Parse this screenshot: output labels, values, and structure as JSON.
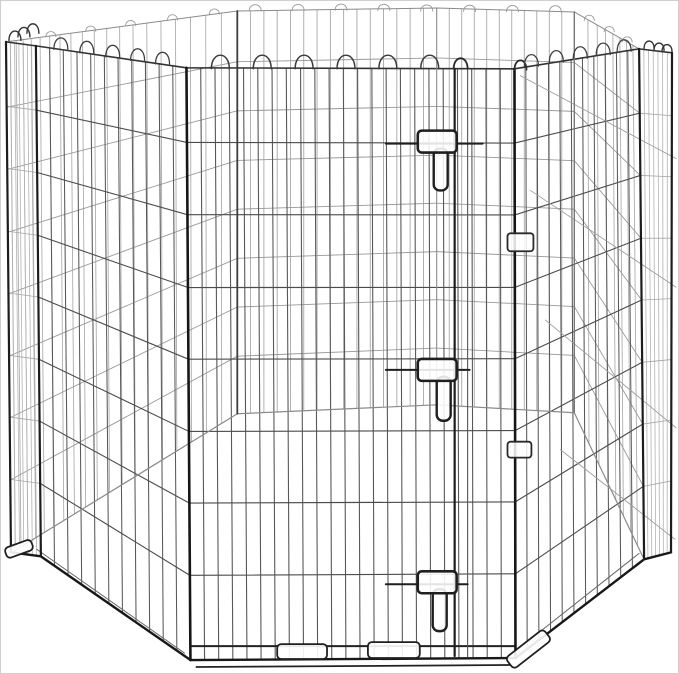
{
  "meta": {
    "alt_text": "Foldable black metal wire octagonal pet exercise pen with door and latches, on white background",
    "canvas": {
      "w": 679,
      "h": 674
    },
    "background": "#ffffff",
    "frame_border": "#cfcfcf"
  },
  "product": {
    "kind": "wire-exercise-pen",
    "visible_panels": "octagonal arrangement",
    "door_latches": 3,
    "hinge_clips": 2,
    "foot_tabs": 4,
    "wire_colors": {
      "dark": "#161616",
      "mid": "#4c4c4c",
      "light": "#9a9a9a",
      "faint": "#b2b2b2"
    }
  },
  "figure": {
    "rows": [
      0.126,
      0.248,
      0.371,
      0.492,
      0.614,
      0.735,
      0.857
    ],
    "panels": [
      {
        "name": "panel-far-left",
        "ta": [
          6,
          42
        ],
        "tb": [
          237,
          10
        ],
        "ba": [
          11,
          553
        ],
        "bb": [
          237,
          414
        ],
        "nv": 19,
        "bias": 1.4,
        "vc": "#a8a8a8",
        "vw": 0.85,
        "hc": "#9a9a9a",
        "hw": 0.9
      },
      {
        "name": "panel-back-left",
        "ta": [
          237,
          10
        ],
        "tb": [
          437,
          7
        ],
        "ba": [
          237,
          414
        ],
        "bb": [
          437,
          405
        ],
        "nv": 14,
        "bias": 1,
        "vc": "#a2a2a2",
        "vw": 0.85,
        "hc": "#989898",
        "hw": 0.9
      },
      {
        "name": "panel-back-right",
        "ta": [
          437,
          7
        ],
        "tb": [
          575,
          11
        ],
        "ba": [
          437,
          405
        ],
        "bb": [
          575,
          413
        ],
        "nv": 10,
        "bias": 1,
        "vc": "#a2a2a2",
        "vw": 0.85,
        "hc": "#989898",
        "hw": 0.9
      },
      {
        "name": "panel-far-right",
        "ta": [
          575,
          11
        ],
        "tb": [
          640,
          48
        ],
        "ba": [
          575,
          413
        ],
        "bb": [
          645,
          560
        ],
        "nv": 7,
        "bias": 0.75,
        "vc": "#a8a8a8",
        "vw": 0.85,
        "hc": "#9a9a9a",
        "hw": 0.9
      },
      {
        "name": "panel-edge-left",
        "ta": [
          5,
          41
        ],
        "tb": [
          35,
          45
        ],
        "ba": [
          10,
          553
        ],
        "bb": [
          40,
          557
        ],
        "nv": 6,
        "bias": 1,
        "vc": "#b2b2b2",
        "vw": 0.8,
        "hc": "#a5a5a5",
        "hw": 0.8
      },
      {
        "name": "panel-edge-right",
        "ta": [
          640,
          48
        ],
        "tb": [
          673,
          52
        ],
        "ba": [
          645,
          560
        ],
        "bb": [
          672,
          553
        ],
        "nv": 6,
        "bias": 1,
        "vc": "#b2b2b2",
        "vw": 0.8,
        "hc": "#a5a5a5",
        "hw": 0.8
      },
      {
        "name": "panel-near-left",
        "ta": [
          35,
          45
        ],
        "tb": [
          186,
          67
        ],
        "ba": [
          40,
          557
        ],
        "bb": [
          190,
          661
        ],
        "nv": 10,
        "bias": 1,
        "vc": "#585858",
        "vw": 1.05,
        "hc": "#4c4c4c",
        "hw": 1.1
      },
      {
        "name": "panel-front-door",
        "ta": [
          186,
          67
        ],
        "tb": [
          515,
          68
        ],
        "ba": [
          190,
          661
        ],
        "bb": [
          516,
          659
        ],
        "nv": 22,
        "bias": 1,
        "vc": "#585858",
        "vw": 1.1,
        "hc": "#4c4c4c",
        "hw": 1.15
      },
      {
        "name": "panel-near-right",
        "ta": [
          515,
          68
        ],
        "tb": [
          640,
          48
        ],
        "ba": [
          516,
          659
        ],
        "bb": [
          645,
          560
        ],
        "nv": 10,
        "bias": 1,
        "vc": "#585858",
        "vw": 1.05,
        "hc": "#4c4c4c",
        "hw": 1.1
      }
    ],
    "far_first": 6,
    "posts": [
      {
        "name": "post-back-left",
        "p": [
          237,
          10,
          237,
          414
        ],
        "w": 1.8,
        "c": "#3c3c3c",
        "far": true
      },
      {
        "name": "post-back-center",
        "p": [
          437,
          7,
          437,
          405
        ],
        "w": 1.1,
        "c": "#8a8a8a",
        "far": true
      },
      {
        "name": "post-back-right",
        "p": [
          575,
          11,
          575,
          413
        ],
        "w": 1.4,
        "c": "#777777",
        "far": true
      },
      {
        "name": "post-corner-left-outer",
        "p": [
          5,
          41,
          10,
          553
        ],
        "w": 2.2,
        "c": "#1c1c1c"
      },
      {
        "name": "post-corner-left-inner",
        "p": [
          35,
          45,
          40,
          557
        ],
        "w": 2.2,
        "c": "#1c1c1c"
      },
      {
        "name": "post-door-left",
        "p": [
          186,
          67,
          190,
          661
        ],
        "w": 2.6,
        "c": "#161616"
      },
      {
        "name": "door-stile-main",
        "p": [
          455,
          68,
          455,
          657
        ],
        "w": 2.2,
        "c": "#1c1c1c"
      },
      {
        "name": "door-stile-secondary",
        "p": [
          468,
          69,
          468,
          658
        ],
        "w": 1.1,
        "c": "#555555"
      },
      {
        "name": "post-door-right",
        "p": [
          515,
          68,
          516,
          659
        ],
        "w": 2.6,
        "c": "#161616"
      },
      {
        "name": "post-corner-right-inner",
        "p": [
          640,
          48,
          645,
          560
        ],
        "w": 2.2,
        "c": "#1c1c1c"
      },
      {
        "name": "post-corner-right-outer",
        "p": [
          673,
          52,
          672,
          553
        ],
        "w": 2.2,
        "c": "#1c1c1c"
      }
    ],
    "polylines": [
      {
        "name": "back-rim-rail",
        "pts": [
          [
            5,
            41
          ],
          [
            237,
            10
          ],
          [
            437,
            7
          ],
          [
            575,
            11
          ],
          [
            640,
            48
          ]
        ],
        "w": 1.0,
        "c": "#8a8a8a",
        "far": true
      },
      {
        "name": "back-bottom-rail",
        "pts": [
          [
            11,
            553
          ],
          [
            237,
            414
          ],
          [
            437,
            405
          ],
          [
            575,
            413
          ],
          [
            645,
            560
          ]
        ],
        "w": 1.2,
        "c": "#8a8a8a",
        "far": true
      },
      {
        "name": "front-rim-rail",
        "pts": [
          [
            5,
            41
          ],
          [
            35,
            45
          ],
          [
            186,
            67
          ],
          [
            515,
            68
          ],
          [
            640,
            48
          ],
          [
            673,
            52
          ]
        ],
        "w": 1.6,
        "c": "#333333"
      },
      {
        "name": "front-bottom-edge",
        "pts": [
          [
            10,
            553
          ],
          [
            40,
            557
          ],
          [
            190,
            661
          ],
          [
            516,
            659
          ],
          [
            645,
            560
          ],
          [
            672,
            553
          ]
        ],
        "w": 2.4,
        "c": "#181818"
      },
      {
        "name": "front-bottom-wire",
        "pts": [
          [
            190,
            647
          ],
          [
            516,
            647
          ]
        ],
        "w": 2.0,
        "c": "#222222"
      },
      {
        "name": "front-ground-edge",
        "pts": [
          [
            196,
            668
          ],
          [
            510,
            666
          ]
        ],
        "w": 1.8,
        "c": "#222222"
      },
      {
        "name": "left-bottom-wire",
        "pts": [
          [
            36,
            550
          ],
          [
            184,
            654
          ]
        ],
        "w": 1.0,
        "c": "#666666"
      },
      {
        "name": "right-bottom-wire",
        "pts": [
          [
            516,
            652
          ],
          [
            640,
            554
          ]
        ],
        "w": 1.0,
        "c": "#666666"
      }
    ],
    "thru_lines": {
      "name": "right-side-through-wires",
      "c": "#9e9e9e",
      "w": 0.9,
      "segs": [
        [
          521,
          75,
          677,
          158
        ],
        [
          531,
          190,
          677,
          287
        ],
        [
          546,
          320,
          677,
          428
        ],
        [
          561,
          450,
          676,
          540
        ]
      ]
    },
    "arch_groups": [
      {
        "name": "back-rim-loops",
        "h": 6,
        "hw": 6,
        "w": 0.9,
        "c": "#999999",
        "far": true,
        "pts": [
          [
            255,
            10
          ],
          [
            298,
            9.7
          ],
          [
            341,
            9.4
          ],
          [
            384,
            9.6
          ],
          [
            427,
            10.2
          ],
          [
            470,
            10.5
          ],
          [
            513,
            10.8
          ],
          [
            556,
            11
          ]
        ]
      },
      {
        "name": "far-left-rim-loops",
        "h": 5,
        "hw": 5,
        "w": 0.9,
        "c": "#999999",
        "far": true,
        "pts": [
          [
            50,
            35.9
          ],
          [
            90,
            30.4
          ],
          [
            130,
            24.8
          ],
          [
            172,
            19
          ],
          [
            214,
            13.2
          ]
        ]
      },
      {
        "name": "far-right-rim-loops",
        "h": 5,
        "hw": 5,
        "w": 0.9,
        "c": "#999999",
        "far": true,
        "pts": [
          [
            590,
            19.5
          ],
          [
            610,
            30.9
          ],
          [
            628,
            41.2
          ]
        ]
      },
      {
        "name": "front-rim-loops",
        "h": 13,
        "hw": 9,
        "w": 1.5,
        "c": "#3a3a3a",
        "pts": [
          [
            220,
            68
          ],
          [
            262,
            68
          ],
          [
            304,
            68
          ],
          [
            346,
            68
          ],
          [
            388,
            68
          ],
          [
            430,
            68
          ]
        ]
      },
      {
        "name": "door-stile-loop",
        "h": 10,
        "hw": 7,
        "w": 1.8,
        "c": "#2a2a2a",
        "pts": [
          [
            461,
            68
          ]
        ]
      },
      {
        "name": "door-post-loop",
        "h": 9,
        "hw": 6,
        "w": 1.8,
        "c": "#2a2a2a",
        "pts": [
          [
            521,
            69
          ]
        ]
      },
      {
        "name": "near-left-rim-loops",
        "h": 11,
        "hw": 7,
        "w": 1.3,
        "c": "#3f3f3f",
        "pts": [
          [
            60,
            48.5
          ],
          [
            86,
            52
          ],
          [
            112,
            56
          ],
          [
            137,
            59.5
          ],
          [
            162,
            63
          ]
        ]
      },
      {
        "name": "near-right-rim-loops",
        "h": 11,
        "hw": 7,
        "w": 1.3,
        "c": "#3f3f3f",
        "pts": [
          [
            532,
            65.3
          ],
          [
            557,
            61.3
          ],
          [
            581,
            57.4
          ],
          [
            604,
            53.8
          ],
          [
            625,
            50.4
          ]
        ]
      },
      {
        "name": "corner-left-loops",
        "h": 9,
        "hw": 6,
        "w": 1.4,
        "c": "#333333",
        "pts": [
          [
            14,
            39.6
          ],
          [
            23,
            36
          ],
          [
            32,
            32.4
          ]
        ]
      },
      {
        "name": "corner-right-loops",
        "h": 7,
        "hw": 5,
        "w": 1.4,
        "c": "#333333",
        "pts": [
          [
            650,
            47.5
          ],
          [
            660,
            49.5
          ],
          [
            668,
            51
          ]
        ]
      }
    ],
    "latches": [
      {
        "name": "door-latch-top",
        "bar": [
          386,
          143,
          483
        ],
        "handle": [
          418,
          130,
          39,
          22
        ],
        "pin": [
          434,
          148,
          14,
          42
        ]
      },
      {
        "name": "door-latch-middle",
        "bar": [
          386,
          370,
          470
        ],
        "handle": [
          418,
          359,
          39,
          22
        ],
        "pin": [
          437,
          377,
          14,
          44
        ]
      },
      {
        "name": "door-latch-bottom",
        "bar": [
          386,
          585,
          468
        ],
        "handle": [
          418,
          572,
          39,
          22
        ],
        "pin": [
          433,
          590,
          14,
          42
        ]
      }
    ],
    "latch_style": {
      "c": "#1f1f1f",
      "bar_w": 2.0,
      "handle_w": 2.6,
      "pin_w": 2.4,
      "fill": "#ffffff",
      "fill_op": 0.88
    },
    "clips": [
      {
        "name": "hinge-clip-upper",
        "r": [
          508,
          233,
          26,
          18
        ]
      },
      {
        "name": "hinge-clip-lower",
        "r": [
          508,
          442,
          24,
          16
        ]
      }
    ],
    "clip_style": {
      "c": "#2a2a2a",
      "w": 1.8,
      "fill": "#ffffff",
      "fill_op": 0.85
    },
    "feet": [
      {
        "name": "foot-tab-front-left",
        "r": [
          277,
          645,
          50,
          15
        ],
        "rot": 0
      },
      {
        "name": "foot-tab-front-right",
        "r": [
          368,
          643,
          52,
          16
        ],
        "rot": 0
      },
      {
        "name": "foot-tab-right-panel",
        "r": [
          505,
          643,
          48,
          14
        ],
        "rot": -38
      },
      {
        "name": "foot-tab-left-corner",
        "r": [
          4,
          544,
          28,
          11
        ],
        "rot": -20
      }
    ],
    "feet_style": {
      "c": "#1f1f1f",
      "w": 1.8,
      "fill": "#ffffff",
      "fill_op": 0.9
    }
  }
}
